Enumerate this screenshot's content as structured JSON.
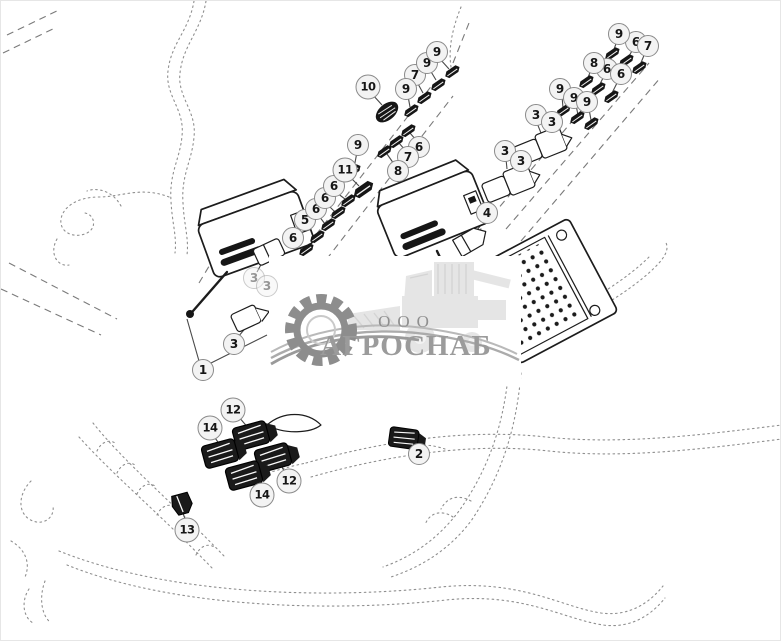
{
  "diagram": {
    "description": "Wiring harness exploded parts diagram",
    "ink_color": "#1c1c1c",
    "phantom_line_color": "#8f8f8f",
    "callout_style": {
      "fill": "#f3f3f3",
      "stroke": "#8a8a8a",
      "text": "#161616"
    },
    "part_numbers_shown": [
      "1",
      "2",
      "3",
      "4",
      "5",
      "6",
      "7",
      "8",
      "9",
      "10",
      "11",
      "12",
      "13",
      "14"
    ],
    "callouts": [
      {
        "label": "1",
        "x": 202,
        "y": 369
      },
      {
        "label": "2",
        "x": 418,
        "y": 453
      },
      {
        "label": "3",
        "x": 233,
        "y": 343
      },
      {
        "label": "3",
        "x": 253,
        "y": 277,
        "faded": true
      },
      {
        "label": "3",
        "x": 266,
        "y": 285,
        "faded": true
      },
      {
        "label": "3",
        "x": 504,
        "y": 150
      },
      {
        "label": "3",
        "x": 520,
        "y": 160
      },
      {
        "label": "3",
        "x": 535,
        "y": 114
      },
      {
        "label": "3",
        "x": 551,
        "y": 121
      },
      {
        "label": "4",
        "x": 486,
        "y": 212
      },
      {
        "label": "5",
        "x": 304,
        "y": 219
      },
      {
        "label": "6",
        "x": 292,
        "y": 237
      },
      {
        "label": "6",
        "x": 315,
        "y": 208
      },
      {
        "label": "6",
        "x": 324,
        "y": 197
      },
      {
        "label": "6",
        "x": 333,
        "y": 185
      },
      {
        "label": "6",
        "x": 418,
        "y": 146
      },
      {
        "label": "6",
        "x": 606,
        "y": 68
      },
      {
        "label": "6",
        "x": 620,
        "y": 73
      },
      {
        "label": "6",
        "x": 635,
        "y": 41
      },
      {
        "label": "7",
        "x": 407,
        "y": 156
      },
      {
        "label": "7",
        "x": 414,
        "y": 74
      },
      {
        "label": "7",
        "x": 647,
        "y": 45
      },
      {
        "label": "8",
        "x": 397,
        "y": 170
      },
      {
        "label": "8",
        "x": 593,
        "y": 62
      },
      {
        "label": "9",
        "x": 357,
        "y": 144
      },
      {
        "label": "9",
        "x": 405,
        "y": 88
      },
      {
        "label": "9",
        "x": 426,
        "y": 62
      },
      {
        "label": "9",
        "x": 436,
        "y": 51
      },
      {
        "label": "9",
        "x": 559,
        "y": 88
      },
      {
        "label": "9",
        "x": 573,
        "y": 97
      },
      {
        "label": "9",
        "x": 586,
        "y": 101
      },
      {
        "label": "9",
        "x": 618,
        "y": 33
      },
      {
        "label": "10",
        "x": 367,
        "y": 86
      },
      {
        "label": "11",
        "x": 344,
        "y": 169
      },
      {
        "label": "12",
        "x": 232,
        "y": 409
      },
      {
        "label": "12",
        "x": 288,
        "y": 480
      },
      {
        "label": "13",
        "x": 186,
        "y": 529
      },
      {
        "label": "14",
        "x": 209,
        "y": 427
      },
      {
        "label": "14",
        "x": 261,
        "y": 494
      }
    ]
  },
  "watermark": {
    "company_prefix": "ООО",
    "company_name": "АГРОСНАБ",
    "prefix_color": "#8f8f8f",
    "name_color": "#9b9b9b",
    "gear_color": "#8d8d8d",
    "vehicle_color": "#e5e5e5"
  }
}
